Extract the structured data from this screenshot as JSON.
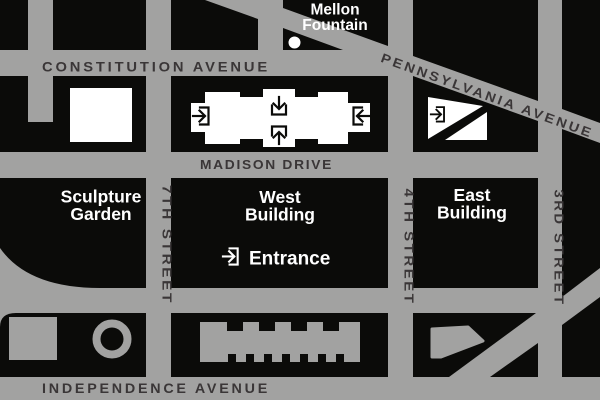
{
  "title": "National Gallery of Art area map",
  "colors": {
    "street_gray": "#a2a2a1",
    "block_black": "#0b0b09",
    "street_label_dark": "#3a3637",
    "white": "#ffffff"
  },
  "streets": {
    "constitution_avenue": "CONSTITUTION AVENUE",
    "pennsylvania_avenue": "PENNSYLVANIA AVENUE",
    "madison_drive": "MADISON DRIVE",
    "independence_avenue": "INDEPENDENCE AVENUE",
    "seventh_street": "7TH STREET",
    "fourth_street": "4TH STREET",
    "third_street": "3RD STREET"
  },
  "landmarks": {
    "mellon_fountain": {
      "line1": "Mellon",
      "line2": "Fountain"
    },
    "sculpture_garden": {
      "line1": "Sculpture",
      "line2": "Garden"
    },
    "west_building": {
      "line1": "West",
      "line2": "Building"
    },
    "east_building": {
      "line1": "East",
      "line2": "Building"
    },
    "entrance": {
      "label": "Entrance"
    }
  }
}
